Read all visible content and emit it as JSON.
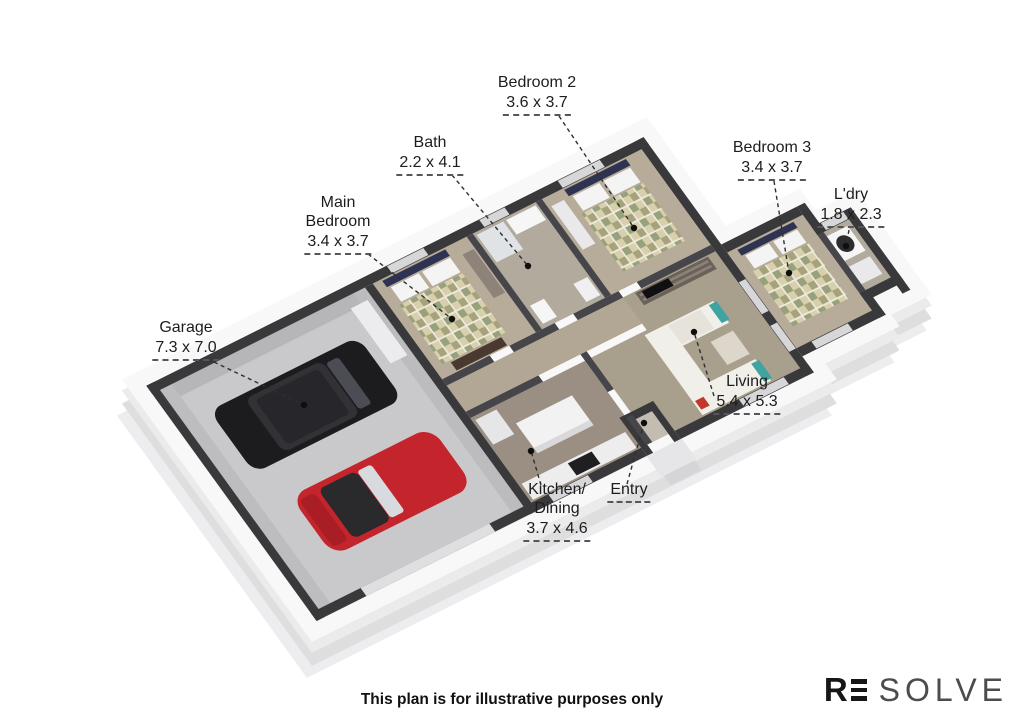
{
  "plan": {
    "labels": [
      {
        "id": "bedroom2",
        "name": "Bedroom 2",
        "name2": "",
        "dims": "3.6 x 3.7"
      },
      {
        "id": "bath",
        "name": "Bath",
        "name2": "",
        "dims": "2.2 x 4.1"
      },
      {
        "id": "bedroom3",
        "name": "Bedroom 3",
        "name2": "",
        "dims": "3.4 x 3.7"
      },
      {
        "id": "laundry",
        "name": "L'dry",
        "name2": "",
        "dims": "1.8 x 2.3"
      },
      {
        "id": "main-bedroom",
        "name": "Main",
        "name2": "Bedroom",
        "dims": "3.4 x 3.7"
      },
      {
        "id": "garage",
        "name": "Garage",
        "name2": "",
        "dims": "7.3 x 7.0"
      },
      {
        "id": "living",
        "name": "Living",
        "name2": "",
        "dims": "5.4 x 5.3"
      },
      {
        "id": "kitchen",
        "name": "Kitchen/",
        "name2": "Dining",
        "dims": "3.7 x 4.6"
      },
      {
        "id": "entry",
        "name": "Entry",
        "name2": "",
        "dims": ""
      }
    ],
    "footer": "This plan is for illustrative purposes only",
    "logo": {
      "r": "R",
      "e": "E",
      "solve": "SOLVE"
    },
    "colors": {
      "wall_top": "#39393b",
      "wall_face": "#f8f8f9",
      "carpet": "#b7ac9a",
      "kitchen_floor": "#9a8f82",
      "garage_floor": "#c9c9cb",
      "suv": "#1c1c1e",
      "sports_car": "#c4242b",
      "sofa_accent": "#3fa3a1"
    }
  }
}
